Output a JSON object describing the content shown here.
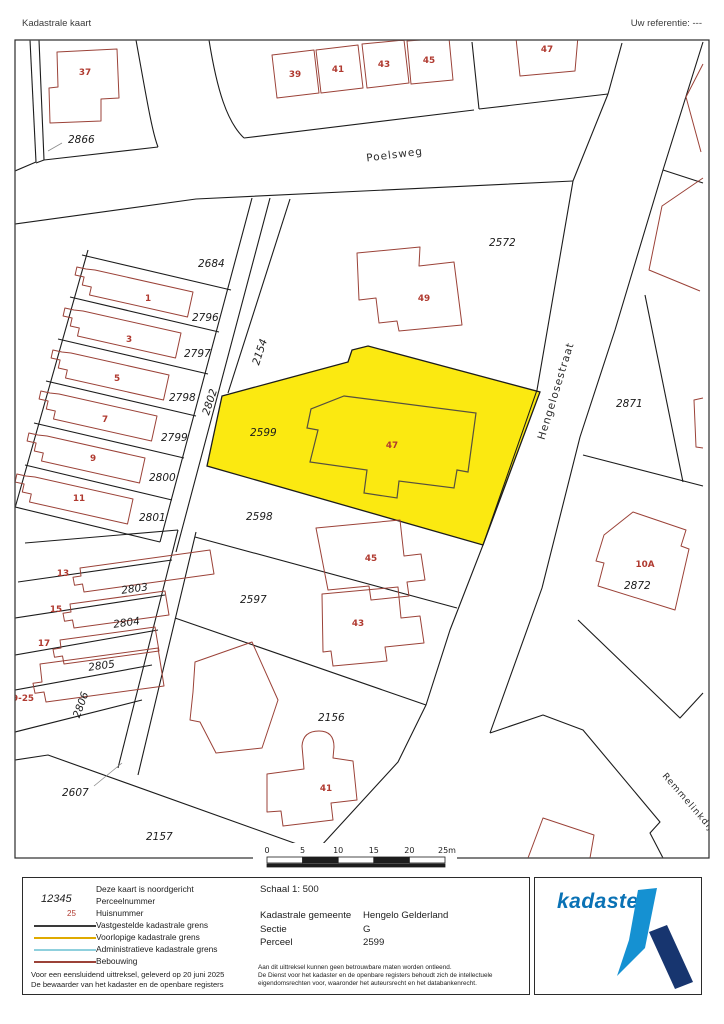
{
  "header": {
    "title": "Kadastrale kaart",
    "reference": "Uw referentie: ---"
  },
  "map": {
    "streets": {
      "poelsweg": "Poelsweg",
      "hengelosestraat": "Hengelosestraat",
      "remmelinkdijk": "Remmelinkdijk"
    },
    "parcels": {
      "p2866": "2866",
      "p2684": "2684",
      "p2796": "2796",
      "p2797": "2797",
      "p2798": "2798",
      "p2799": "2799",
      "p2800": "2800",
      "p2801": "2801",
      "p2802": "2802",
      "p2154": "2154",
      "p2572": "2572",
      "p2599": "2599",
      "p2598": "2598",
      "p2597": "2597",
      "p2803": "2803",
      "p2804": "2804",
      "p2805": "2805",
      "p2806": "2806",
      "p2607": "2607",
      "p2156": "2156",
      "p2157": "2157",
      "p2871": "2871",
      "p2872": "2872"
    },
    "houses": {
      "h37": "37",
      "h39": "39",
      "h41_top": "41",
      "h43_top": "43",
      "h45_top": "45",
      "h47_top": "47",
      "h49": "49",
      "h1": "1",
      "h3": "3",
      "h5": "5",
      "h7": "7",
      "h9": "9",
      "h11": "11",
      "h13": "13",
      "h15": "15",
      "h17": "17",
      "h19_25": "19-25",
      "h47": "47",
      "h45": "45",
      "h43": "43",
      "h41": "41",
      "h10a": "10A"
    },
    "highlight_parcel": "2599",
    "colors": {
      "highlight": "#fbe911",
      "building_outline": "#9b4238",
      "parcel_line": "#1c1c1c",
      "house_number": "#b03a30"
    }
  },
  "scalebar": {
    "ticks": [
      "0",
      "5",
      "10",
      "15",
      "20",
      "25m"
    ]
  },
  "legend": {
    "north_note": "Deze kaart is noordgericht",
    "items": [
      {
        "symbol": "parcel-number-sample",
        "sample": "12345",
        "label": "Perceelnummer"
      },
      {
        "symbol": "house-number-sample",
        "sample": "25",
        "label": "Huisnummer"
      },
      {
        "symbol": "line-black",
        "color": "#3a3a3a",
        "label": "Vastgestelde kadastrale grens"
      },
      {
        "symbol": "line-yellow",
        "color": "#dfaa00",
        "label": "Voorlopige kadastrale grens"
      },
      {
        "symbol": "line-blue",
        "color": "#8fd0dd",
        "label": "Administratieve kadastrale grens"
      },
      {
        "symbol": "line-darkred",
        "color": "#9b4238",
        "label": "Bebouwing"
      }
    ],
    "footnote1": "Voor een eensluidend uittreksel, geleverd op 20 juni 2025",
    "footnote2": "De bewaarder van het kadaster en de openbare registers"
  },
  "info": {
    "scale_label": "Schaal 1: 500",
    "rows": [
      {
        "label": "Kadastrale gemeente",
        "value": "Hengelo Gelderland"
      },
      {
        "label": "Sectie",
        "value": "G"
      },
      {
        "label": "Perceel",
        "value": "2599"
      }
    ],
    "disclaimer1": "Aan dit uittreksel kunnen geen betrouwbare maten worden ontleend.",
    "disclaimer2": "De Dienst voor het kadaster en de openbare registers behoudt zich de intellectuele",
    "disclaimer3": "eigendomsrechten voor, waaronder het auteursrecht en het databankenrecht."
  },
  "logo": {
    "text": "kadaster",
    "light_blue": "#1591d2",
    "dark_blue": "#17356f"
  }
}
